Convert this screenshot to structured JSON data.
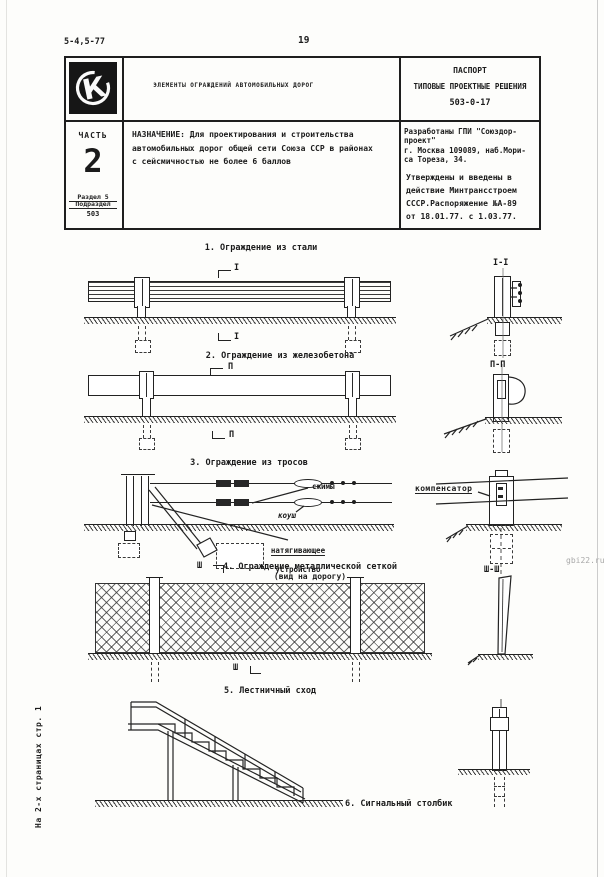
{
  "page": {
    "code": "5-4,5-77",
    "number": "19",
    "side_note": "На 2-х страницах стр. 1",
    "watermark": "gbi22.ru"
  },
  "header": {
    "logo_glyph": "К",
    "title": "ЭЛЕМЕНТЫ ОГРАЖДЕНИЙ АВТОМОБИЛЬНЫХ ДОРОГ",
    "passport_line1": "ПАСПОРТ",
    "passport_line2": "ТИПОВЫЕ ПРОЕКТНЫЕ РЕШЕНИЯ",
    "passport_number": "503-0-17",
    "part_label": "ЧАСТЬ",
    "part_number": "2",
    "razdel": "Раздел 5",
    "podrazdel": "Подраздел",
    "podrazdel_code": "503",
    "purpose": "НАЗНАЧЕНИЕ: Для проектирования и строительства\nавтомобильных дорог общей сети Союза ССР в районах\nс сейсмичностью не более 6 баллов",
    "developer": "Разработаны ГПИ \"Союздор-\nпроект\"\nг. Москва 109089, наб.Мори-\nса Тореза, 34.",
    "approval": "Утверждены и  введены в\nдействие Минтрансстроем\nСССР.Распоряжение №А-89\nот 18.01.77. с 1.03.77."
  },
  "figures": {
    "fig1": {
      "title": "1. Ограждение из стали",
      "marker": "I",
      "section": "I-I"
    },
    "fig2": {
      "title": "2. Ограждение из железобетона",
      "marker": "П",
      "section": "П-П"
    },
    "fig3": {
      "title": "3. Ограждение из тросов",
      "label_clamps": "сжимы",
      "label_thimble": "коуш",
      "label_tensioner1": "натягивающее",
      "label_tensioner2": "устройство",
      "label_compensator": "компенсатор"
    },
    "fig4": {
      "title": "4. Ограждение металлической сеткой",
      "subtitle": "(вид на дорогу)",
      "marker": "Ш",
      "section": "Ш-Ш"
    },
    "fig5": {
      "title": "5. Лестничный сход"
    },
    "fig6": {
      "title": "6. Сигнальный столбик"
    }
  }
}
